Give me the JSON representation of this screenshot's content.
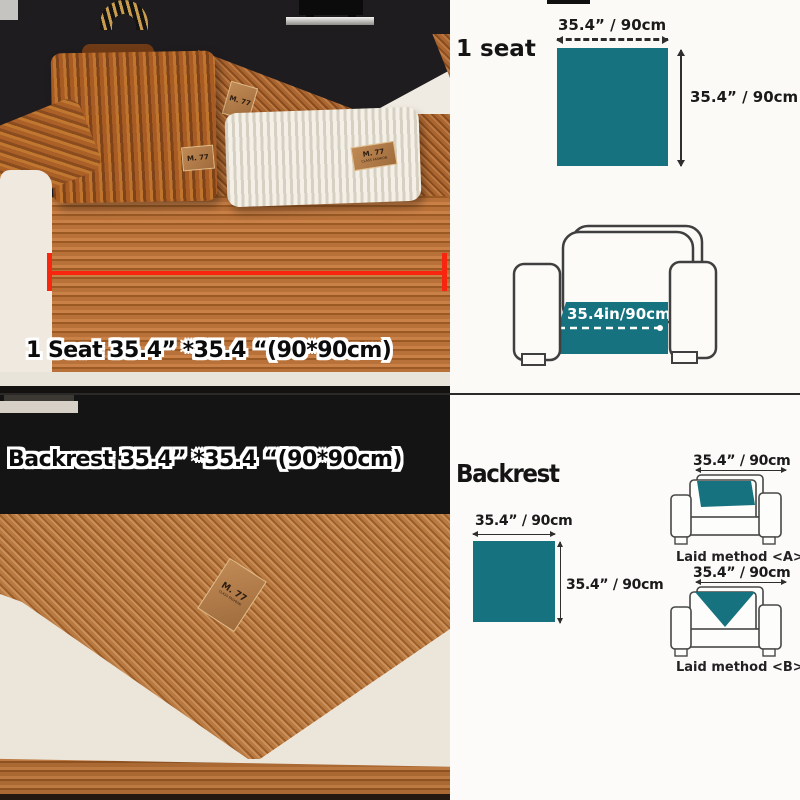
{
  "colors": {
    "teal": "#17727f",
    "red": "#f8250f"
  },
  "top_left": {
    "caption": "1 Seat 35.4” *35.4 “(90*90cm)",
    "brand_tag": {
      "line1": "M. 77",
      "line2": "CLASS FASHION"
    }
  },
  "top_right": {
    "title": "1 seat",
    "square": {
      "width_label": "35.4” / 90cm",
      "height_label": "35.4” / 90cm"
    },
    "chair_seat_label": "35.4in/90cm"
  },
  "bottom_left": {
    "caption": "Backrest 35.4” *35.4 “(90*90cm)",
    "brand_tag": {
      "line1": "M. 77",
      "line2": "CLASS FASHION"
    }
  },
  "bottom_right": {
    "title": "Backrest",
    "square": {
      "width_label": "35.4” / 90cm",
      "height_label": "35.4” / 90cm"
    },
    "method_a": {
      "dim_label": "35.4” / 90cm",
      "caption": "Laid method <A>"
    },
    "method_b": {
      "dim_label": "35.4” / 90cm",
      "caption": "Laid method <B>"
    }
  }
}
